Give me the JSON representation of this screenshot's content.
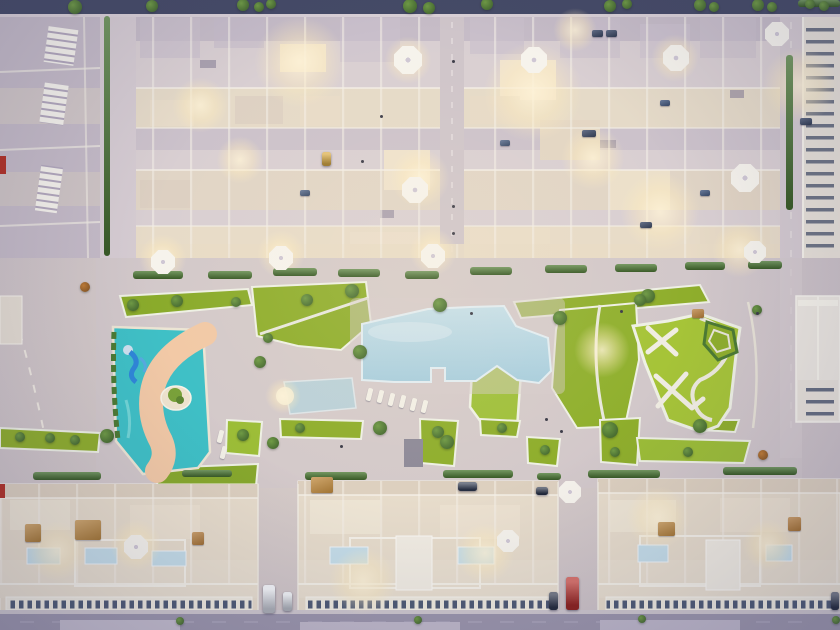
{
  "scene": {
    "setting": "aerial-dusk-view",
    "subject": "residential-apartment-complex-with-pool-courtyard"
  },
  "palette": {
    "pavement": "#c7bdc7",
    "pavement_warm": "#ddd0c4",
    "street_top": "#454a66",
    "street_bottom": "#9c96ac",
    "building_wall": "#e7dccb",
    "building_roof": "#c3b9c6",
    "white_trim": "#f5f1e8",
    "lawn": "#8fae2c",
    "lawn_bright": "#a6c438",
    "hedge": "#4c7a33",
    "tree": "#55823c",
    "pool_water": "#b8d8e6",
    "lazy_river_water": "#3fc0c6",
    "sand": "#f2c9a6",
    "slide_blue": "#2f86d8",
    "umbrella": "#f6f3ec",
    "furniture_orange": "#c08a3e",
    "vehicle_red": "#c1261b",
    "vehicle_white": "#eef0f3",
    "vehicle_dark": "#2b3345",
    "vehicle_yellow": "#d4a02c",
    "glow_warm": "#ffeebe"
  },
  "props": {
    "glows": [
      [
        300,
        62,
        46
      ],
      [
        533,
        92,
        50
      ],
      [
        800,
        85,
        38
      ],
      [
        593,
        158,
        32
      ],
      [
        660,
        212,
        40
      ],
      [
        420,
        178,
        30
      ],
      [
        200,
        105,
        28
      ],
      [
        240,
        160,
        24
      ],
      [
        163,
        258,
        24
      ],
      [
        281,
        254,
        24
      ],
      [
        433,
        252,
        24
      ],
      [
        740,
        250,
        28
      ],
      [
        283,
        396,
        18
      ],
      [
        602,
        350,
        28
      ],
      [
        57,
        551,
        30
      ],
      [
        136,
        545,
        26
      ],
      [
        363,
        581,
        34
      ],
      [
        485,
        553,
        30
      ],
      [
        658,
        518,
        32
      ],
      [
        768,
        545,
        26
      ],
      [
        575,
        30,
        22
      ],
      [
        675,
        58,
        24
      ],
      [
        408,
        60,
        24
      ]
    ],
    "hedges": [
      [
        133,
        271,
        50,
        8
      ],
      [
        208,
        271,
        44,
        8
      ],
      [
        273,
        268,
        44,
        8
      ],
      [
        338,
        269,
        42,
        8
      ],
      [
        405,
        271,
        34,
        8
      ],
      [
        470,
        267,
        42,
        8
      ],
      [
        545,
        265,
        42,
        8
      ],
      [
        615,
        264,
        42,
        8
      ],
      [
        685,
        262,
        40,
        8
      ],
      [
        748,
        261,
        34,
        8
      ],
      [
        33,
        472,
        68,
        8
      ],
      [
        182,
        470,
        50,
        7
      ],
      [
        305,
        472,
        62,
        8
      ],
      [
        443,
        470,
        70,
        8
      ],
      [
        537,
        473,
        24,
        7
      ],
      [
        588,
        470,
        72,
        8
      ],
      [
        723,
        467,
        74,
        8
      ],
      [
        104,
        16,
        6,
        240
      ],
      [
        786,
        55,
        7,
        155
      ],
      [
        798,
        0,
        42,
        7
      ]
    ],
    "trees": [
      [
        75,
        7,
        7
      ],
      [
        152,
        6,
        6
      ],
      [
        243,
        5,
        6
      ],
      [
        259,
        7,
        5
      ],
      [
        271,
        4,
        5
      ],
      [
        410,
        6,
        7
      ],
      [
        429,
        8,
        6
      ],
      [
        487,
        4,
        6
      ],
      [
        610,
        6,
        6
      ],
      [
        627,
        4,
        5
      ],
      [
        700,
        5,
        6
      ],
      [
        714,
        7,
        5
      ],
      [
        758,
        5,
        6
      ],
      [
        772,
        7,
        5
      ],
      [
        810,
        4,
        5
      ],
      [
        824,
        6,
        5
      ],
      [
        133,
        305,
        6
      ],
      [
        177,
        301,
        6
      ],
      [
        236,
        302,
        5
      ],
      [
        307,
        300,
        6
      ],
      [
        352,
        291,
        7
      ],
      [
        440,
        305,
        7
      ],
      [
        560,
        318,
        7
      ],
      [
        648,
        296,
        7
      ],
      [
        268,
        338,
        5
      ],
      [
        360,
        352,
        7
      ],
      [
        85,
        287,
        5,
        "#c07c35"
      ],
      [
        610,
        430,
        8
      ],
      [
        700,
        426,
        7
      ],
      [
        380,
        428,
        7
      ],
      [
        447,
        442,
        7
      ],
      [
        260,
        362,
        6
      ],
      [
        273,
        443,
        6
      ],
      [
        107,
        436,
        7
      ],
      [
        243,
        435,
        6
      ],
      [
        300,
        428,
        5
      ],
      [
        438,
        432,
        6
      ],
      [
        502,
        428,
        5
      ],
      [
        545,
        450,
        5
      ],
      [
        50,
        438,
        5
      ],
      [
        20,
        437,
        5
      ],
      [
        75,
        440,
        5
      ],
      [
        615,
        452,
        5
      ],
      [
        688,
        452,
        5
      ],
      [
        640,
        300,
        6
      ],
      [
        757,
        310,
        5
      ],
      [
        763,
        455,
        5,
        "#c07c35"
      ],
      [
        180,
        621,
        4
      ],
      [
        418,
        620,
        4
      ],
      [
        642,
        619,
        4
      ],
      [
        836,
        620,
        4
      ]
    ],
    "umbrellas": [
      [
        408,
        60,
        14
      ],
      [
        415,
        190,
        13
      ],
      [
        534,
        60,
        13
      ],
      [
        676,
        58,
        13
      ],
      [
        745,
        178,
        14
      ],
      [
        777,
        34,
        12
      ],
      [
        755,
        252,
        11
      ],
      [
        163,
        262,
        12
      ],
      [
        281,
        258,
        12
      ],
      [
        433,
        256,
        12
      ],
      [
        508,
        541,
        11
      ],
      [
        136,
        547,
        12
      ],
      [
        570,
        492,
        11
      ]
    ],
    "loungers": [
      [
        367,
        388
      ],
      [
        378,
        390
      ],
      [
        389,
        393
      ],
      [
        400,
        395
      ],
      [
        411,
        398
      ],
      [
        422,
        400
      ],
      [
        218,
        430
      ],
      [
        221,
        446
      ]
    ],
    "furniture": [
      [
        75,
        520,
        26,
        20,
        "#c08a3e"
      ],
      [
        25,
        524,
        16,
        18,
        "#c08a3e"
      ],
      [
        192,
        532,
        12,
        13,
        "#b97f3a"
      ],
      [
        311,
        477,
        22,
        16,
        "#c08a3e"
      ],
      [
        658,
        522,
        17,
        14,
        "#c08a3e"
      ],
      [
        788,
        517,
        13,
        14,
        "#bd8038"
      ],
      [
        692,
        309,
        12,
        9,
        "#b97f3a"
      ],
      [
        582,
        130,
        14,
        7,
        "#2e3d5e"
      ],
      [
        640,
        222,
        12,
        6,
        "#2e3d5e"
      ],
      [
        800,
        118,
        12,
        7,
        "#2e3d5e"
      ],
      [
        592,
        30,
        11,
        7,
        "#2e3d5e"
      ],
      [
        606,
        30,
        11,
        7,
        "#2e3d5e"
      ],
      [
        300,
        190,
        10,
        6,
        "#39507a"
      ],
      [
        500,
        140,
        10,
        6,
        "#39507a"
      ],
      [
        700,
        190,
        10,
        6,
        "#39507a"
      ],
      [
        660,
        100,
        10,
        6,
        "#39507a"
      ]
    ],
    "vehicles": [
      [
        "red-truck",
        566,
        577,
        13,
        33,
        "#c1261b"
      ],
      [
        "white-van",
        263,
        585,
        12,
        28,
        "#eef0f3"
      ],
      [
        "white-car",
        283,
        592,
        9,
        19,
        "#e8ebee"
      ],
      [
        "dark-car",
        549,
        592,
        9,
        18,
        "#2b3345"
      ],
      [
        "dark-car",
        831,
        592,
        8,
        18,
        "#2b3345"
      ],
      [
        "yellow-cart",
        322,
        152,
        9,
        14,
        "#d4a02c"
      ],
      [
        "dark-car",
        458,
        482,
        19,
        9,
        "#30394e"
      ],
      [
        "dark-car",
        536,
        487,
        12,
        8,
        "#272f42"
      ]
    ],
    "people": [
      [
        361,
        160
      ],
      [
        380,
        115
      ],
      [
        452,
        232
      ],
      [
        452,
        205
      ],
      [
        470,
        312
      ],
      [
        560,
        430
      ],
      [
        756,
        312
      ],
      [
        620,
        310
      ],
      [
        340,
        445
      ],
      [
        545,
        418
      ],
      [
        452,
        60
      ]
    ]
  }
}
